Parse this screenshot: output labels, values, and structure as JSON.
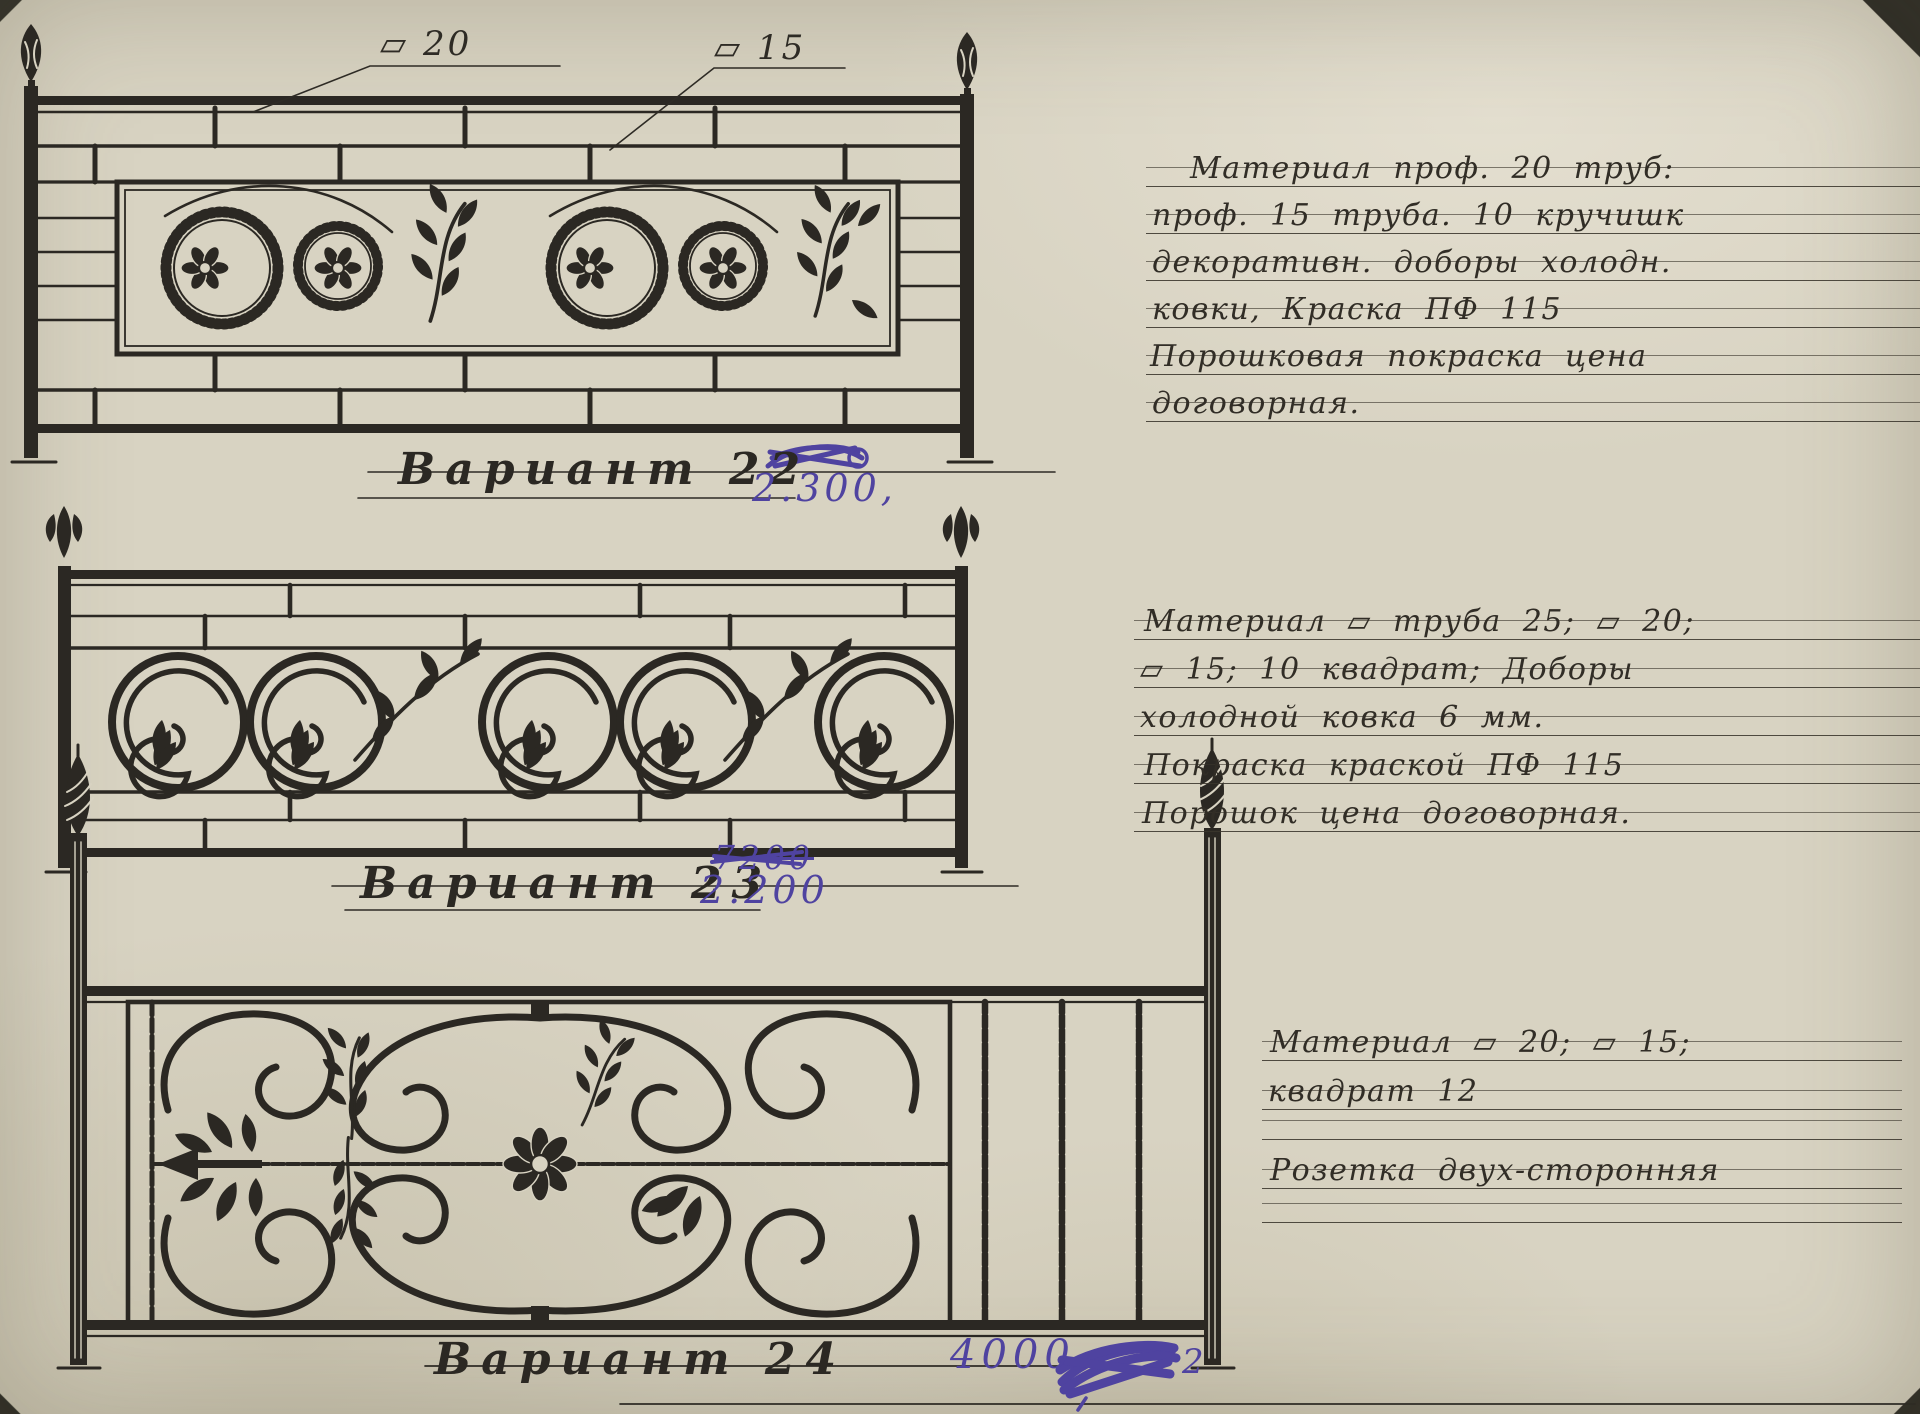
{
  "document": {
    "dim_labels": {
      "left": "▱ 20",
      "right": "▱ 15"
    },
    "variants": [
      {
        "label": "Вариант 22",
        "price": "2.300,"
      },
      {
        "label": "Вариант 23",
        "price_crossed": "7200",
        "price": "2.200"
      },
      {
        "label": "Вариант 24",
        "price": "4000",
        "price_scribble_tail": "2"
      }
    ],
    "notes": [
      {
        "lines": [
          "Материал проф. 20 труб:",
          "проф. 15 труба. 10 кручишк",
          "декоративн. доборы холодн.",
          "ковки, Краска ПФ 115",
          "Порошковая покраска цена",
          "договорная."
        ]
      },
      {
        "lines": [
          "Материал ▱ труба 25; ▱ 20;",
          "▱ 15; 10 квадрат; Доборы",
          "холодной ковка 6 мм.",
          "Покраска краской ПФ 115",
          "Порошок цена договорная."
        ]
      },
      {
        "lines": [
          "Материал ▱ 20; ▱ 15;",
          "квадрат 12",
          "",
          "Розетка двух-сторонняя",
          ""
        ]
      }
    ],
    "colors": {
      "paper": "#d8d3c2",
      "ink": "#2b2823",
      "pen_purple": "#4f43a0"
    }
  }
}
